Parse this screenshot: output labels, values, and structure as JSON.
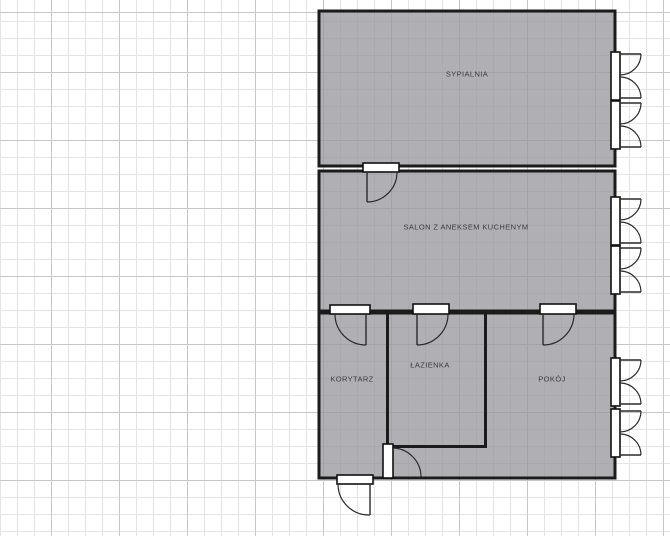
{
  "editor": {
    "type": "floor-plan",
    "background": "grid"
  },
  "colors": {
    "wall": "#1b1b1b",
    "room_fill": "#b1b1b5",
    "grid_minor": "#e4e4e6",
    "grid_major": "#c7c7cc",
    "canvas_background": "#ffffff",
    "label_text": "#3c3c3c",
    "opening_fill": "#ffffff"
  },
  "rooms": [
    {
      "id": "sypialnia",
      "label": "SYPIALNIA"
    },
    {
      "id": "salon",
      "label": "SALON Z ANEKSEM KUCHENYM"
    },
    {
      "id": "korytarz",
      "label": "KORYTARZ"
    },
    {
      "id": "lazienka",
      "label": "ŁAZIENKA"
    },
    {
      "id": "pokoj",
      "label": "POKÓJ"
    }
  ],
  "fixtures": {
    "doors": [
      "door-sypialnia-salon",
      "door-salon-korytarz",
      "door-salon-lazienka",
      "door-salon-pokoj",
      "door-korytarz-passage",
      "entrance-door"
    ],
    "windows": [
      "window-sypialnia-upper",
      "window-sypialnia-lower",
      "window-salon-upper",
      "window-salon-lower",
      "window-pokoj-upper",
      "window-pokoj-lower"
    ]
  }
}
